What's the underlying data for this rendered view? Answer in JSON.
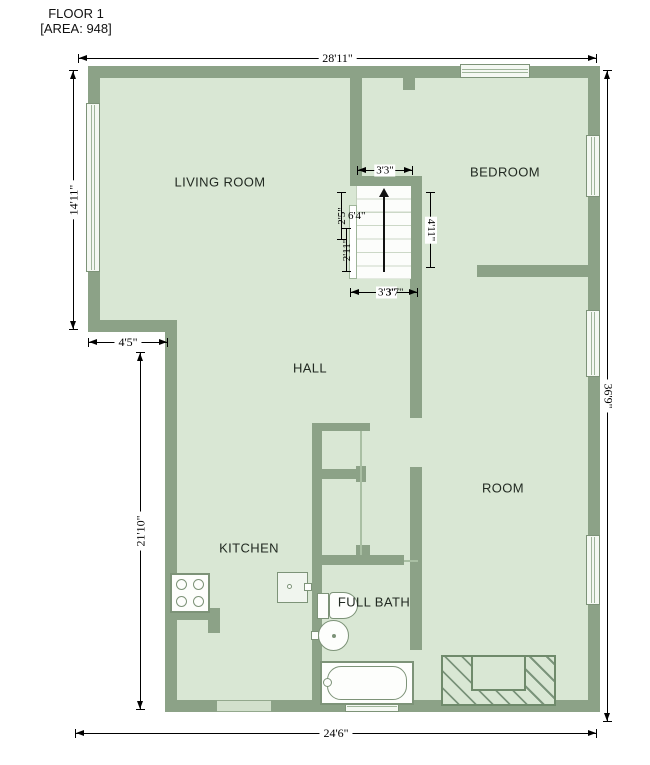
{
  "title": {
    "floor": "FLOOR 1",
    "area": "[AREA: 948]"
  },
  "rooms": {
    "living_room": "LIVING ROOM",
    "bedroom": "BEDROOM",
    "hall": "HALL",
    "kitchen": "KITCHEN",
    "room": "ROOM",
    "full_bath": "FULL BATH"
  },
  "dims": {
    "top": "28'11\"",
    "left_upper": "14'11\"",
    "left_notch": "4'5\"",
    "left_lower": "21'10\"",
    "bottom": "24'6\"",
    "right": "36'9\"",
    "stair_top": "3'3\"",
    "stair_right": "4'11\"",
    "stair_bottom_a": "3'3\"",
    "stair_bottom_b": "3'7\"",
    "stair_left_a": "2'5\"",
    "stair_left_b": "6'4\"",
    "stair_left_c": "2'11\""
  },
  "fixtures": [
    "stairs-up-arrow",
    "stove-4-burners",
    "kitchen-appliance",
    "toilet",
    "round-sink",
    "bathtub",
    "hatched-exterior-stairs"
  ],
  "windows": [
    "left-living-room",
    "top-bedroom",
    "right-bedroom",
    "right-room-upper",
    "right-room-lower",
    "bottom-bath"
  ],
  "colors": {
    "wall": "#8ca287",
    "floor": "#d9e7d4",
    "window_fill": "#f4f8f2",
    "fixture_outline": "#7d9378",
    "dimension": "#000000",
    "label_text": "#222a22",
    "hatch": "#6f8a6b"
  }
}
